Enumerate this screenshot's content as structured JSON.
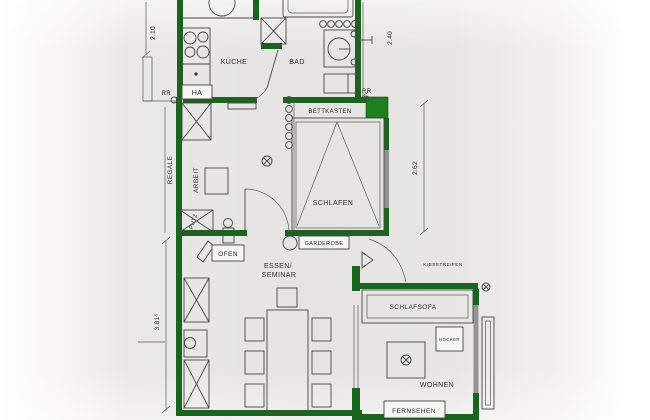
{
  "plan_title": "apartment-floor-plan",
  "colors": {
    "wall_green": "#1a651d",
    "accent_green": "#1f7e20",
    "window_gray": "#939393",
    "line": "#454545",
    "text": "#2e2e2e",
    "paper": "#e7e6e4"
  },
  "rooms": {
    "kitchen": "KÜCHE",
    "bath": "BAD",
    "bed_box": "BETTKASTEN",
    "bedroom": "SCHLAFEN",
    "wardrobe": "GARDEROBE",
    "dining_line1": "ESSEN/",
    "dining_line2": "SEMINAR",
    "living": "WOHNEN"
  },
  "furniture": {
    "oven": "OFEN",
    "sofa": "SCHLAFSOFA",
    "stool": "HOCKER",
    "tv": "FERNSEHEN",
    "shelves": "REGALE",
    "work": "ARBEIT",
    "cleaning": "PUTZ"
  },
  "annotations": {
    "ha": "HA",
    "rr_left": "RR",
    "rr_right": "RR",
    "gravel_strip": "KIESSTREIFEN"
  },
  "dimensions": {
    "kitchen_width": "2.10",
    "bath_depth": "2.40",
    "bedroom_depth": "2.62",
    "dining_depth": "3.81⁵"
  }
}
